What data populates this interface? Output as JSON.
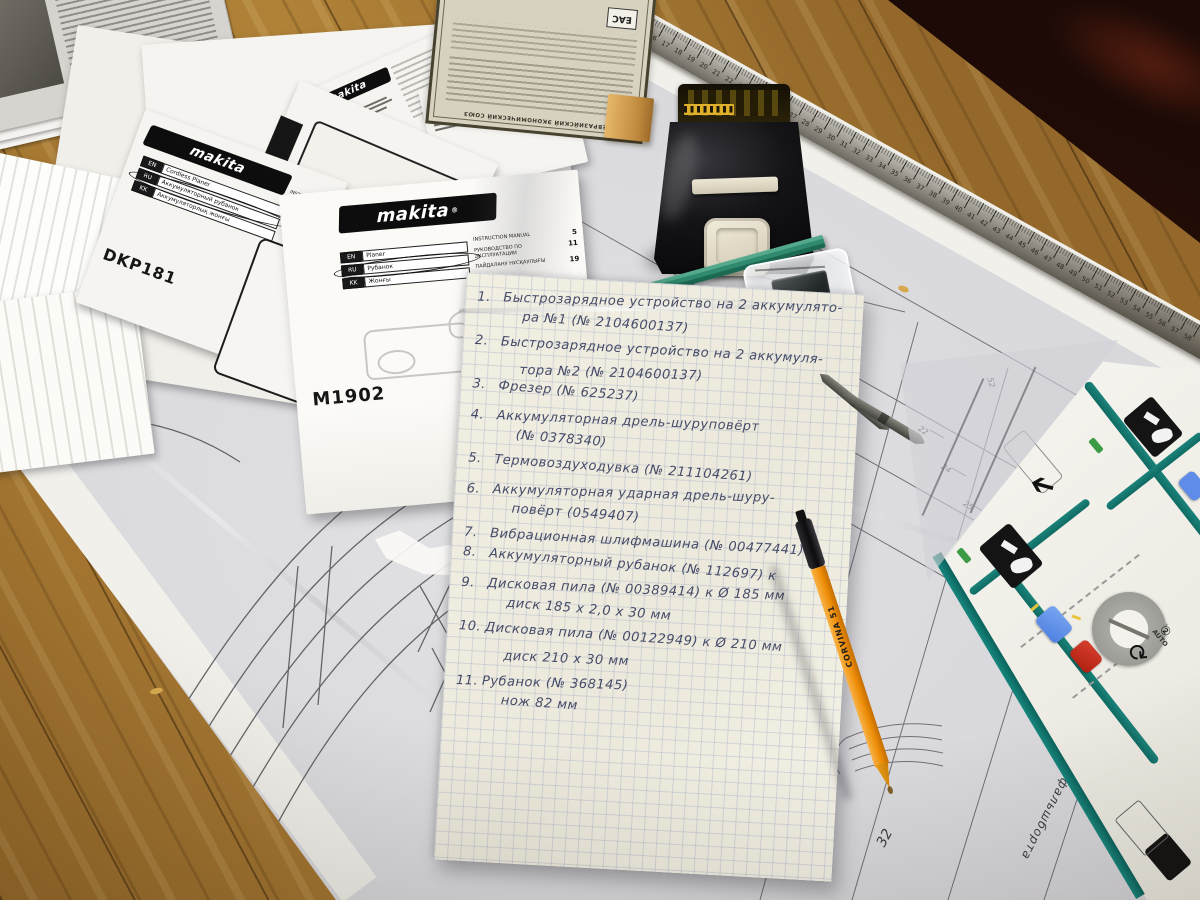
{
  "note": {
    "items": [
      {
        "num": "1.",
        "rows": [
          "Быстрозарядное устройство на 2 аккумулято-",
          "ра №1  (№ 2104600137)"
        ]
      },
      {
        "num": "2.",
        "rows": [
          "Быстрозарядное устройство на 2 аккумуля-",
          "тора №2  (№ 2104600137)"
        ]
      },
      {
        "num": "3.",
        "rows": [
          "Фрезер    (№ 625237)"
        ]
      },
      {
        "num": "4.",
        "rows": [
          "Аккумуляторная дрель-шуруповёрт",
          "(№ 0378340)"
        ]
      },
      {
        "num": "5.",
        "rows": [
          "Термовоздуходувка  (№ 211104261)"
        ]
      },
      {
        "num": "6.",
        "rows": [
          "Аккумуляторная ударная дрель-шуру-",
          "повёрт   (0549407)"
        ]
      },
      {
        "num": "7.",
        "rows": [
          "Вибрационная шлифмашина (№ 00477441) к"
        ]
      },
      {
        "num": "8.",
        "rows": [
          "Аккумуляторный рубанок (№ 112697) к"
        ]
      },
      {
        "num": "9.",
        "rows": [
          "Дисковая пила (№ 00389414) к    Ø 185 мм",
          "диск  185 х 2,0 х 30 мм"
        ]
      },
      {
        "num": "10.",
        "rows": [
          "Дисковая пила (№ 00122949) к Ø 210 мм",
          "диск  210 х 30 мм"
        ]
      },
      {
        "num": "11.",
        "rows": [
          "Рубанок  (№ 368145)",
          "нож  82 мм"
        ]
      }
    ]
  },
  "manual_m1902": {
    "brand": "makita",
    "brand_mark": "®",
    "model": "M1902",
    "langs": [
      {
        "code": "EN",
        "name": "Planer"
      },
      {
        "code": "RU",
        "name": "Рубанок"
      },
      {
        "code": "KK",
        "name": "Жонғы"
      }
    ],
    "toc": [
      {
        "label": "INSTRUCTION MANUAL",
        "page": "5"
      },
      {
        "label": "РУКОВОДСТВО ПО ЭКСПЛУАТАЦИИ",
        "page": "11"
      },
      {
        "label": "ПАЙДАЛАНУ НҰСҚАУЛЫҒЫ",
        "page": "19"
      }
    ]
  },
  "manual_dkp181": {
    "brand": "makita",
    "model": "DKP181",
    "langs": [
      {
        "code": "EN",
        "name": "Cordless Planer"
      },
      {
        "code": "RU",
        "name": "Аккумуляторный рубанок"
      },
      {
        "code": "KK",
        "name": "Аккумуляторлық жонғы"
      }
    ],
    "toc": [
      "INSTRUCTION MANUAL",
      "РУКОВОДСТВО ПО ЭКСПЛУАТАЦИИ",
      "ПАЙДАЛАНУ НҰСҚАУЛЫҒЫ"
    ]
  },
  "manual_5008": {
    "brand": "makita",
    "model_lines": [
      "5008MG",
      "5008MGA"
    ]
  },
  "certificate": {
    "mark": "ЕАС",
    "title": "ЕВРАЗИЙСКИЙ ЭКОНОМИЧЕСКИЙ СОЮЗ"
  },
  "ruler": {
    "from": 13,
    "to": 58
  },
  "pen": {
    "brand": "CORVINA 51"
  },
  "quickstart": {
    "dial_label": "AUTO",
    "step_mark": "②"
  },
  "blueprint_labels": [
    {
      "text": "фальшборта"
    },
    {
      "text": "32"
    },
    {
      "text": "22"
    },
    {
      "text": "24"
    },
    {
      "text": "25"
    },
    {
      "text": "52"
    }
  ],
  "colors": {
    "pen_orange": "#ef8e08",
    "cap_red": "#c72517",
    "quickstart_teal": "#157a72",
    "pencil_green": "#2f8a70",
    "battery_black": "#141417"
  }
}
